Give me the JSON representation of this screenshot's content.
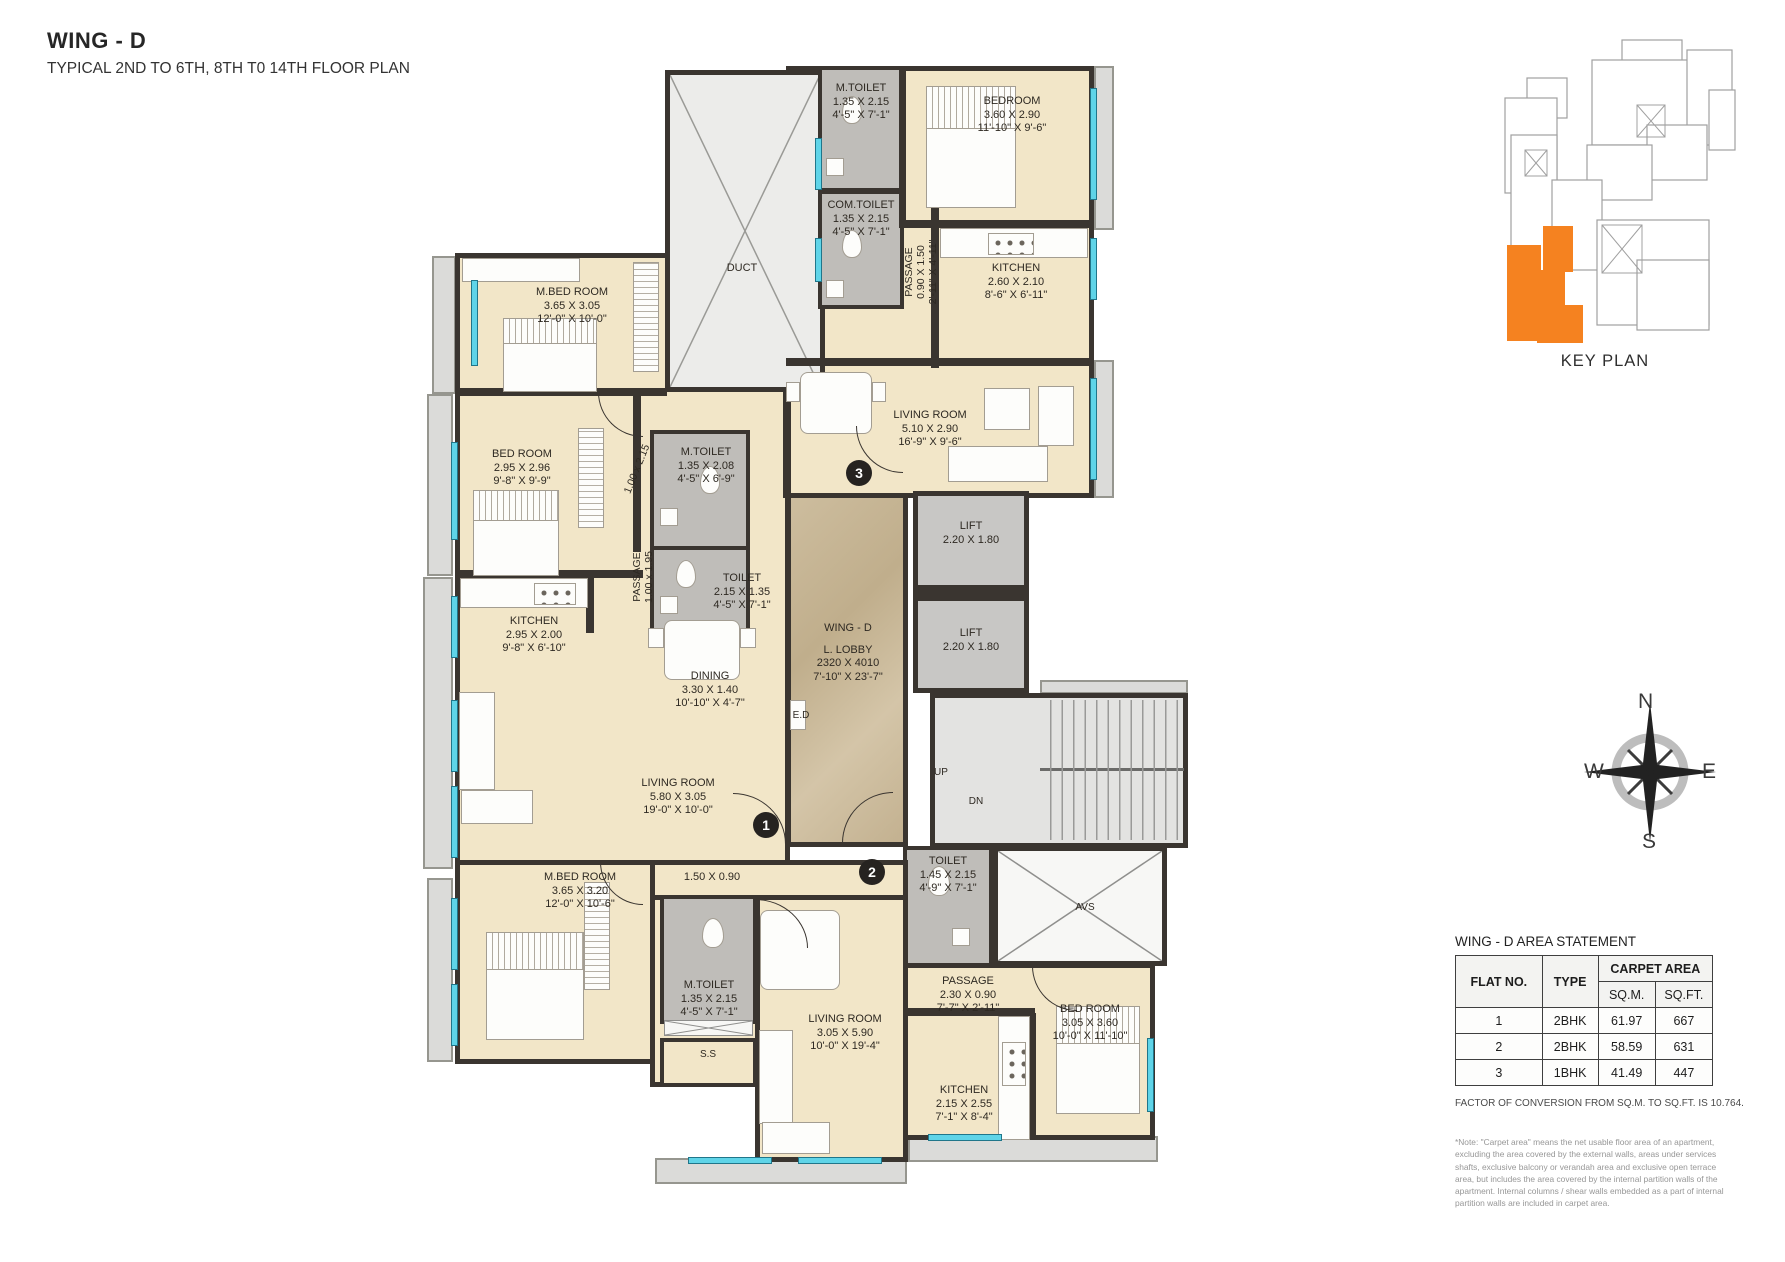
{
  "header": {
    "title": "WING - D",
    "subtitle": "TYPICAL 2ND TO 6TH, 8TH T0 14TH FLOOR PLAN"
  },
  "key_plan": {
    "label": "KEY PLAN",
    "highlight_color": "#F58220"
  },
  "compass": {
    "n": "N",
    "e": "E",
    "s": "S",
    "w": "W"
  },
  "badges": {
    "f1": "1",
    "f2": "2",
    "f3": "3"
  },
  "rooms": {
    "duct": {
      "name": "DUCT"
    },
    "f3_mtoilet": {
      "name": "M.TOILET",
      "m": "1.35 X 2.15",
      "ft": "4'-5\" X 7'-1\""
    },
    "f3_bedroom": {
      "name": "BEDROOM",
      "m": "3.60 X 2.90",
      "ft": "11'-10\" X 9'-6\""
    },
    "f3_comtoilet": {
      "name": "COM.TOILET",
      "m": "1.35 X 2.15",
      "ft": "4'-5\" X 7'-1\""
    },
    "f3_passage": {
      "name": "PASSAGE",
      "m": "0.90 X 1.50",
      "ft": "2'-11\" X 4'-11\""
    },
    "f3_kitchen": {
      "name": "KITCHEN",
      "m": "2.60 X 2.10",
      "ft": "8'-6\" X 6'-11\""
    },
    "f3_living": {
      "name": "LIVING ROOM",
      "m": "5.10 X 2.90",
      "ft": "16'-9\" X 9'-6\""
    },
    "f1_mbed": {
      "name": "M.BED ROOM",
      "m": "3.65 X 3.05",
      "ft": "12'-0\" X 10'-0\""
    },
    "f1_bed": {
      "name": "BED ROOM",
      "m": "2.95 X 2.96",
      "ft": "9'-8\" X 9'-9\""
    },
    "f1_mtoilet": {
      "name": "M.TOILET",
      "m": "1.35 X 2.08",
      "ft": "4'-5\" X 6'-9\""
    },
    "f1_pass_a": {
      "m": "1.00 x 2.15"
    },
    "f1_passage": {
      "name": "PASSAGE",
      "m": "1.00 x 1.95"
    },
    "f1_toilet": {
      "name": "TOILET",
      "m": "2.15 X 1.35",
      "ft": "4'-5\" X 7'-1\""
    },
    "f1_kitchen": {
      "name": "KITCHEN",
      "m": "2.95 X 2.00",
      "ft": "9'-8\" X 6'-10\""
    },
    "f1_dining": {
      "name": "DINING",
      "m": "3.30 X 1.40",
      "ft": "10'-10\" X 4'-7\""
    },
    "f1_living": {
      "name": "LIVING ROOM",
      "m": "5.80 X 3.05",
      "ft": "19'-0\" X 10'-0\""
    },
    "lobby": {
      "wing": "WING - D",
      "name": "L. LOBBY",
      "m": "2320 X 4010",
      "ft": "7'-10\" X 23'-7\""
    },
    "lift": {
      "name": "LIFT",
      "m": "2.20 X 1.80"
    },
    "ed": "E.D",
    "up": "UP",
    "dn": "DN",
    "avs": "AVS",
    "ss": "S.S",
    "f2_corridor": {
      "m": "1.50 X 0.90"
    },
    "f2_mbed": {
      "name": "M.BED ROOM",
      "m": "3.65 X 3.20",
      "ft": "12'-0\" X 10'-6\""
    },
    "f2_mtoilet": {
      "name": "M.TOILET",
      "m": "1.35 X 2.15",
      "ft": "4'-5\" X 7'-1\""
    },
    "f2_toilet": {
      "name": "TOILET",
      "m": "1.45 X 2.15",
      "ft": "4'-9\" X 7'-1\""
    },
    "f2_passage": {
      "name": "PASSAGE",
      "m": "2.30 X 0.90",
      "ft": "7'-7\" X 2'-11\""
    },
    "f2_living": {
      "name": "LIVING ROOM",
      "m": "3.05 X 5.90",
      "ft": "10'-0\" X 19'-4\""
    },
    "f2_bed": {
      "name": "BED ROOM",
      "m": "3.05 X 3.60",
      "ft": "10'-0\" X 11'-10\""
    },
    "f2_kitchen": {
      "name": "KITCHEN",
      "m": "2.15 X 2.55",
      "ft": "7'-1\" X 8'-4\""
    }
  },
  "area_table": {
    "title": "WING - D  AREA STATEMENT",
    "col_flat": "FLAT NO.",
    "col_type": "TYPE",
    "col_carpet": "CARPET AREA",
    "col_sqm": "SQ.M.",
    "col_sqft": "SQ.FT.",
    "rows": [
      {
        "flat": "1",
        "type": "2BHK",
        "sqm": "61.97",
        "sqft": "667"
      },
      {
        "flat": "2",
        "type": "2BHK",
        "sqm": "58.59",
        "sqft": "631"
      },
      {
        "flat": "3",
        "type": "1BHK",
        "sqm": "41.49",
        "sqft": "447"
      }
    ],
    "conversion_note": "FACTOR OF CONVERSION FROM SQ.M. TO SQ.FT. IS 10.764.",
    "carpet_note": "*Note: \"Carpet area\" means the net usable floor area of an apartment, excluding the area covered by the external walls, areas under services shafts, exclusive balcony or verandah area and exclusive open terrace area, but includes the area covered by the internal partition walls of the apartment. Internal columns / shear walls embedded as a part of internal partition walls are included in carpet area."
  }
}
